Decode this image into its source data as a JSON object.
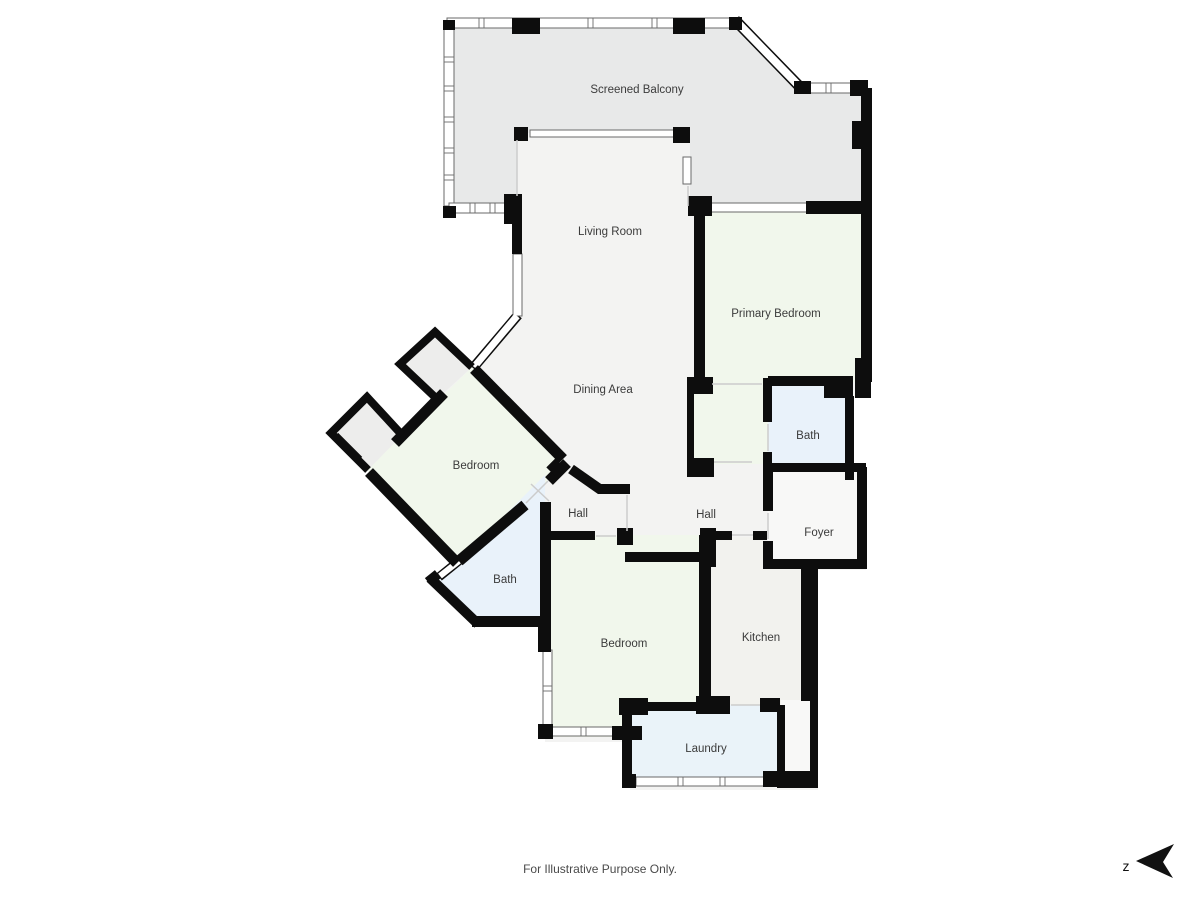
{
  "plan": {
    "rooms": {
      "screened_balcony": {
        "label": "Screened Balcony"
      },
      "living_room": {
        "label": "Living Room"
      },
      "primary_bedroom": {
        "label": "Primary Bedroom"
      },
      "dining_area": {
        "label": "Dining Area"
      },
      "bedroom_upper": {
        "label": "Bedroom"
      },
      "bath_primary": {
        "label": "Bath"
      },
      "hall_west": {
        "label": "Hall"
      },
      "hall_east": {
        "label": "Hall"
      },
      "foyer": {
        "label": "Foyer"
      },
      "bath_west": {
        "label": "Bath"
      },
      "bedroom_lower": {
        "label": "Bedroom"
      },
      "kitchen": {
        "label": "Kitchen"
      },
      "laundry": {
        "label": "Laundry"
      }
    },
    "colors": {
      "wall": "#0d0d0d",
      "balcony": "#e8e9e9",
      "open_area": "#f3f3f2",
      "bedroom": "#f1f7ec",
      "bath": "#e9f2fa",
      "kitchen": "#f2f2ee",
      "foyer": "#f8f8f7",
      "laundry": "#eaf3f9",
      "closet": "#ededec"
    },
    "footer": {
      "disclaimer": "For Illustrative Purpose Only."
    },
    "compass": {
      "label": "z"
    }
  }
}
